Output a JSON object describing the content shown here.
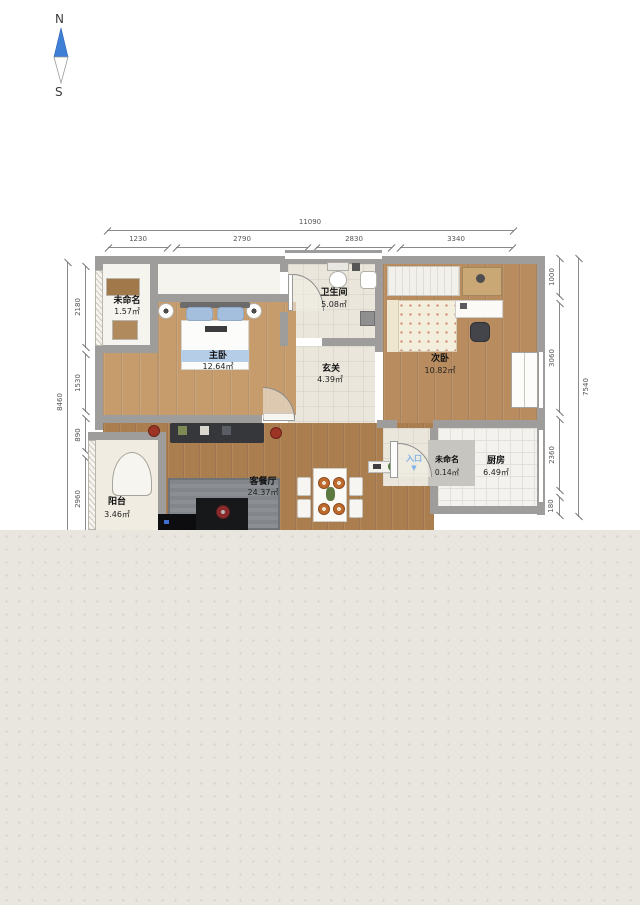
{
  "compass": {
    "north": "N",
    "south": "S"
  },
  "dimensions": {
    "top": {
      "total": "11090",
      "segments": [
        "1230",
        "2790",
        "2830",
        "3340"
      ]
    },
    "left": {
      "total": "8460",
      "segments": [
        "2180",
        "1530",
        "890",
        "2960"
      ]
    },
    "right": {
      "total": "7540",
      "segments": [
        "1000",
        "3060",
        "2360",
        "180"
      ]
    }
  },
  "rooms": [
    {
      "name": "未命名",
      "area": "1.57㎡"
    },
    {
      "name": "主卧",
      "area": "12.64㎡"
    },
    {
      "name": "卫生间",
      "area": "5.08㎡"
    },
    {
      "name": "玄关",
      "area": "4.39㎡"
    },
    {
      "name": "次卧",
      "area": "10.82㎡"
    },
    {
      "name": "客餐厅",
      "area": "24.37㎡"
    },
    {
      "name": "未命名",
      "area": "0.14㎡"
    },
    {
      "name": "厨房",
      "area": "6.49㎡"
    },
    {
      "name": "阳台",
      "area": "3.46㎡"
    }
  ],
  "entrance": {
    "label": "入口",
    "arrow": "▼"
  },
  "colors": {
    "wall": "#9e9d9b",
    "wood_living": "#ab7e50",
    "wood_master": "#c69c6d",
    "wood_second": "#b88c5e",
    "tile": "#eae6db",
    "canvas_background": "#e9e6df",
    "compass_needle": "#3f7fd6",
    "entrance_text": "#7fb2e6"
  }
}
